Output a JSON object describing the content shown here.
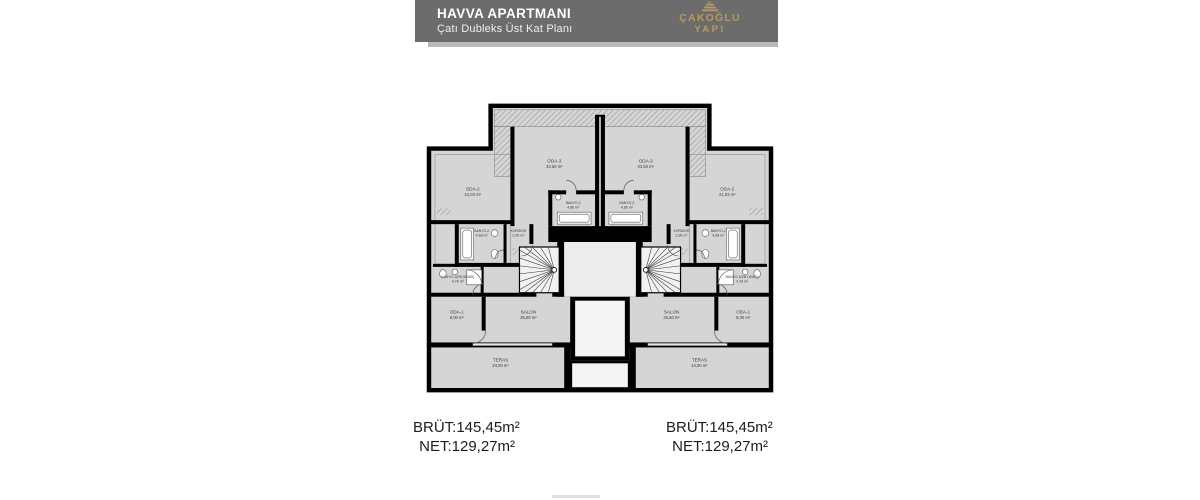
{
  "header": {
    "title": "HAVVA APARTMANI",
    "subtitle": "Çatı Dubleks Üst Kat Planı",
    "brand": {
      "line1": "ÇAKOĞLU",
      "line2": "YAPI"
    },
    "colors": {
      "bar": "#6c6c6c",
      "underline": "#b9b9b9",
      "brand_gold": "#b49a62",
      "title_text": "#ffffff"
    }
  },
  "plan": {
    "colors": {
      "wall": "#000000",
      "floor": "#d5d5d5",
      "stair_fill": "#f2f2f2",
      "lobby_fill": "#ececec",
      "shaft_fill": "#ffffff",
      "background": "#ffffff"
    },
    "rooms": [
      {
        "id": "oda3",
        "name": "ODA-3",
        "area": "33,50 m²"
      },
      {
        "id": "oda2",
        "name": "ODA-2",
        "area": "21,03 m²"
      },
      {
        "id": "banyo3",
        "name": "BANYO-3",
        "area": "4,86 m²"
      },
      {
        "id": "koridor",
        "name": "KORIDOR",
        "area": "2,90 m²"
      },
      {
        "id": "banyo2",
        "name": "BANYO-2",
        "area": "4,68 m²"
      },
      {
        "id": "banyo1",
        "name": "BANYO-1(EB.ODASI)",
        "area": "4,78 m²"
      },
      {
        "id": "oda1",
        "name": "ODA-1",
        "area": "8,00 m²"
      },
      {
        "id": "salon",
        "name": "SALON",
        "area": "25,50 m²"
      },
      {
        "id": "teras",
        "name": "TERAS",
        "area": "24,00 m²"
      }
    ],
    "units": [
      {
        "id": "left",
        "brut": "BRÜT:145,45m²",
        "net": "NET:129,27m²"
      },
      {
        "id": "right",
        "brut": "BRÜT:145,45m²",
        "net": "NET:129,27m²"
      }
    ]
  }
}
